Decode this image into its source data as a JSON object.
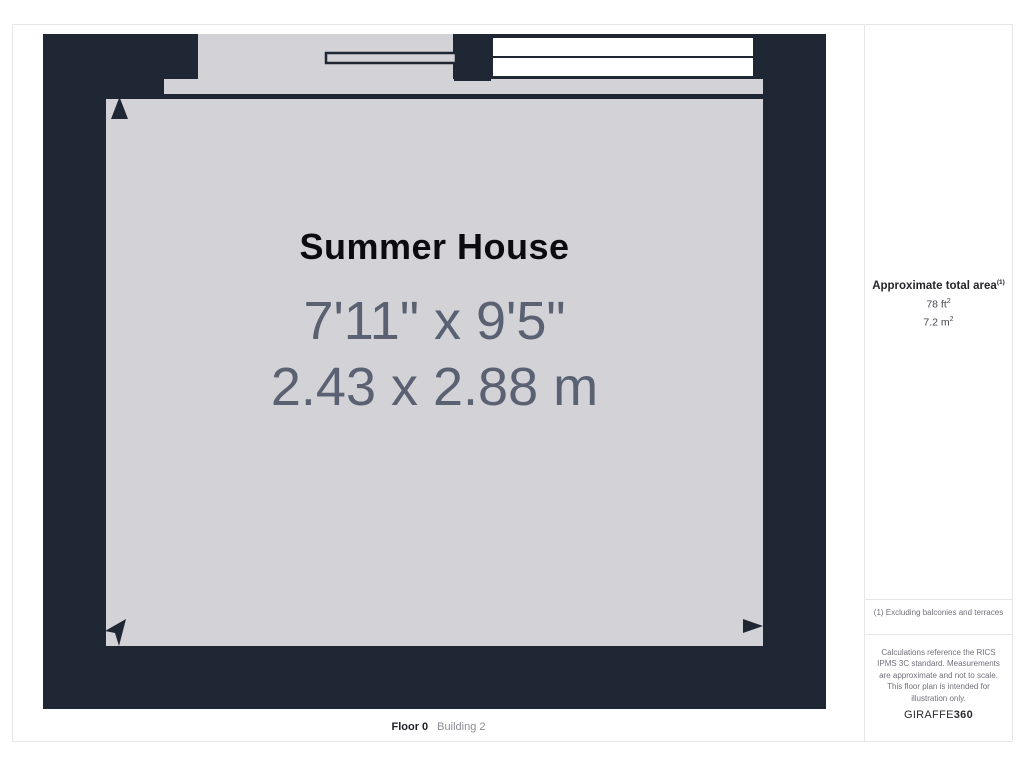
{
  "plan": {
    "room_name": "Summer House",
    "dimensions_imperial": "7'11\" x 9'5\"",
    "dimensions_metric": "2.43 x 2.88 m",
    "floor_label": "Floor 0",
    "building_label": "Building 2"
  },
  "sidebar": {
    "area_title": "Approximate total area",
    "area_title_sup": "(1)",
    "area_imperial": "78 ft",
    "area_imperial_sup": "2",
    "area_metric": "7.2 m",
    "area_metric_sup": "2",
    "footnote": "(1) Excluding balconies and terraces",
    "disclaimer": "Calculations reference the RICS IPMS 3C standard. Measurements are approximate and not to scale. This floor plan is intended for illustration only.",
    "brand_prefix": "GIRAFFE",
    "brand_suffix": "360"
  },
  "colors": {
    "wall": "#1f2734",
    "floor": "#d3d2d6",
    "window_pane": "#ffffff",
    "dimension_text": "#5a6173",
    "room_name_text": "#0c0c0f",
    "muted_text": "#71717a",
    "divider": "#e9e6e8"
  }
}
